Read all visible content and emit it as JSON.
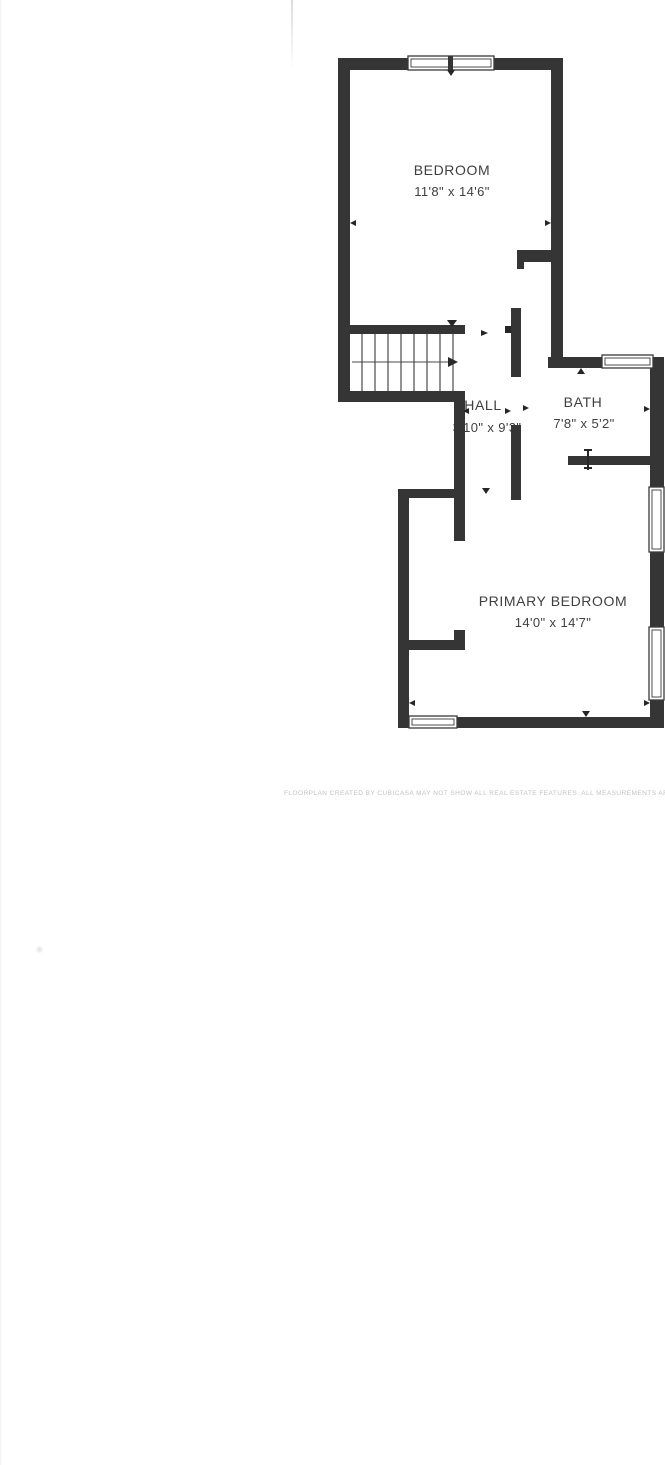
{
  "floorplan": {
    "type": "floor-plan",
    "wall_color": "#353535",
    "background_color": "#ffffff",
    "rooms": [
      {
        "name": "BEDROOM",
        "dimensions": "11'8\" x 14'6\""
      },
      {
        "name": "HALL",
        "dimensions": "3'10\" x 9'3\""
      },
      {
        "name": "BATH",
        "dimensions": "7'8\" x 5'2\""
      },
      {
        "name": "PRIMARY BEDROOM",
        "dimensions": "14'0\" x 14'7\""
      }
    ],
    "features": [
      "staircase-with-up-arrow",
      "window-symbols",
      "door-opening-markers"
    ],
    "disclaimer": "FLOORPLAN CREATED BY CUBICASA MAY NOT SHOW ALL REAL ESTATE FEATURES. ALL MEASUREMENTS ARE APPROXIMATE."
  }
}
